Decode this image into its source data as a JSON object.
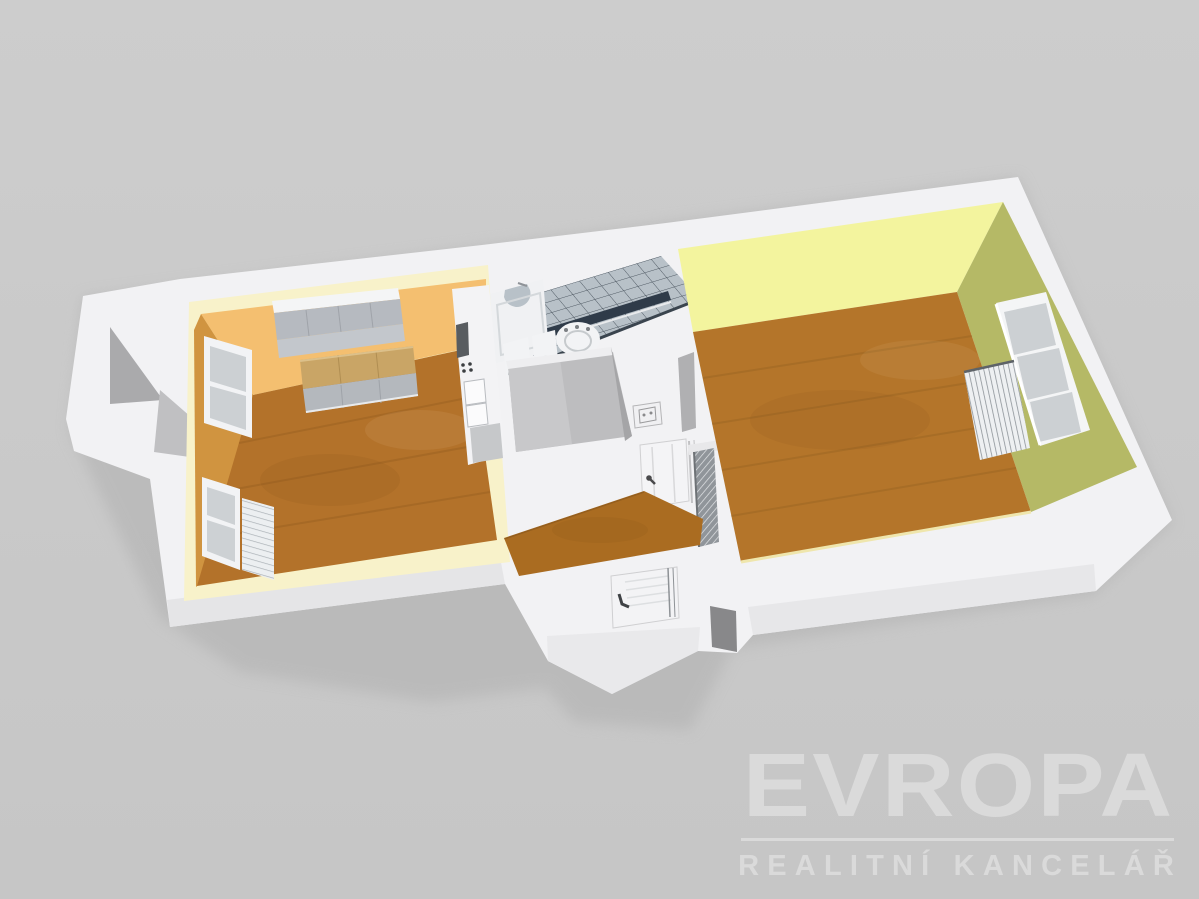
{
  "watermark": {
    "brand": "EVROPA",
    "tagline": "REALITNÍ KANCELÁŘ",
    "color": "#dadada"
  },
  "scene": {
    "type": "3d-floor-plan-render",
    "objects": [
      "kitchen-room",
      "kitchen-upper-cabinets",
      "kitchen-counter",
      "kitchen-base-cabinets",
      "kitchen-window",
      "kitchen-radiator",
      "tall-appliance-column",
      "bathroom-tiled-wall",
      "bathtub",
      "washing-machine",
      "pedestal-fixtures",
      "hallway",
      "interior-door",
      "electric-panel",
      "doorway-with-radiator",
      "entrance-vestibule",
      "front-door",
      "living-room",
      "living-room-window",
      "living-room-radiator"
    ]
  },
  "colors": {
    "background": "#cacaca",
    "shadow": "#b3b3b3",
    "wall_white": "#f2f2f4",
    "wall_face_shade": "#e5e5e7",
    "wall_dark_face": "#88888a",
    "kitchen_trim": "#f8f2ca",
    "kitchen_back_wall": "#f4bf70",
    "kitchen_side_wall": "#d09440",
    "kitchen_floor": "#b3722a",
    "counter_wood": "#c9a566",
    "cabinet_gray": "#b6bac0",
    "tile": "#b8c1c8",
    "tile_line": "#4b555f",
    "tile_accent": "#2f3b49",
    "hall_floor": "#aa6c21",
    "living_back_wall": "#f3f49e",
    "living_side_wall": "#b5b966",
    "living_floor": "#b4752a",
    "fixture_white": "#f2f3f5",
    "watermark": "#dadada"
  }
}
